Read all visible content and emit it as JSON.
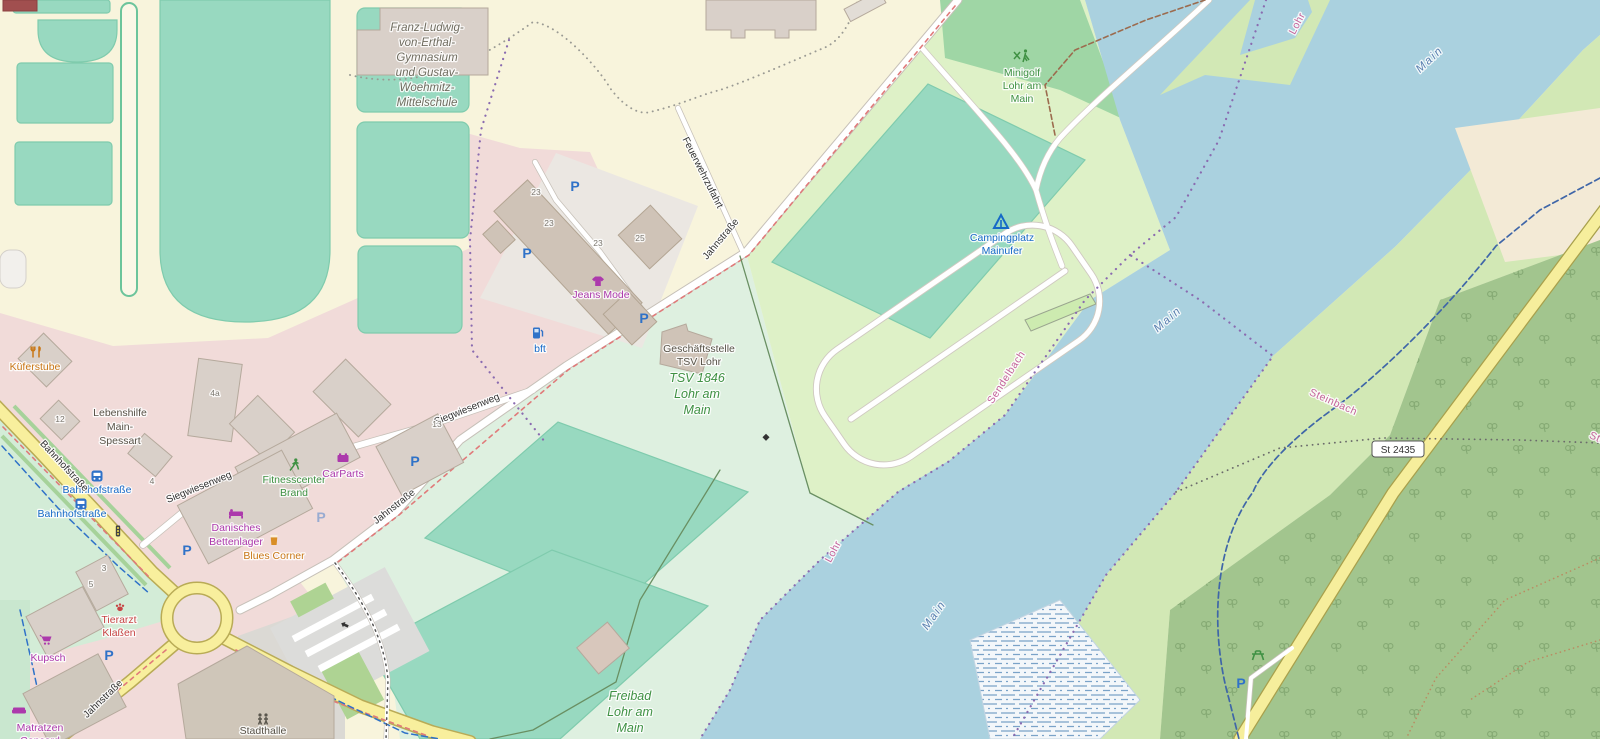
{
  "map": {
    "labels": {
      "school": {
        "lines": [
          "Franz-Ludwig-",
          "von-Erthal-",
          "Gymnasium",
          "und Gustav-",
          "Woehmitz-",
          "Mittelschule"
        ]
      },
      "minigolf": {
        "lines": [
          "Minigolf",
          "Lohr am",
          "Main"
        ]
      },
      "camping": {
        "lines": [
          "Campingplatz",
          "Mainufer"
        ]
      },
      "tsv_office": {
        "lines": [
          "Geschäftsstelle",
          "TSV Lohr"
        ]
      },
      "tsv_club": {
        "lines": [
          "TSV 1846",
          "Lohr am",
          "Main"
        ]
      },
      "freibad": {
        "lines": [
          "Freibad",
          "Lohr am",
          "Main"
        ]
      },
      "lebenshilfe": {
        "lines": [
          "Lebenshilfe",
          "Main-",
          "Spessart"
        ]
      },
      "fitnesscenter": {
        "lines": [
          "Fitnesscenter",
          "Brand"
        ]
      },
      "danisches": {
        "lines": [
          "Danisches",
          "Bettenlager"
        ]
      },
      "matratzen": {
        "lines": [
          "Matratzen",
          "Concord"
        ]
      },
      "tierarzt": {
        "lines": [
          "Tierarzt",
          "Klaßen"
        ]
      },
      "kueferstube": "Küferstube",
      "kupsch": "Kupsch",
      "carparts": "CarParts",
      "blues_corner": "Blues Corner",
      "jeans_mode": "Jeans Mode",
      "stadthalle": "Stadthalle",
      "bft": "bft"
    },
    "roads": {
      "jahnstrasse": "Jahnstraße",
      "bahnhofstrasse": "Bahnhofstraße",
      "siegwiesenweg": "Siegwiesenweg",
      "feuerwehrzufahrt": "Feuerwehrzufahrt",
      "ref_st2435": "St 2435"
    },
    "waterways": {
      "main": "Main",
      "lohr": "Lohr",
      "sendelbach": "Sendelbach",
      "steinbach": "Steinbach"
    },
    "bus_stop": "Bahnhofstraße",
    "house_numbers": {
      "n23": "23",
      "n25": "25",
      "n4a": "4a",
      "n12": "12",
      "n4": "4",
      "n13": "13",
      "n3": "3",
      "n5": "5"
    },
    "symbols": {
      "parking": "P"
    },
    "colors": {
      "water": "#aad1df",
      "school_ground": "#f8f4dc",
      "retail_pink": "#f1dbd9",
      "pitch_teal": "#98d9c0",
      "sports_mint": "#def0e0",
      "camp_green": "#def1c7",
      "minigolf_green": "#9fd6a5",
      "bank_grass": "#d2e8b5",
      "forest": "#a2c58e",
      "park_mint": "#d3ecd7",
      "building": "#d9d0c9",
      "road_yellow": "#f8ef9d",
      "road_white": "#ffffff",
      "poi_blue": "#1569c7",
      "poi_green": "#3f9143",
      "poi_magenta": "#ac39ac",
      "poi_orange": "#c97716",
      "poi_red": "#c74444",
      "water_label_blue": "#5a80b0",
      "stream_label_rose": "#c4639a",
      "parking_blue": "#2f72c8"
    }
  }
}
